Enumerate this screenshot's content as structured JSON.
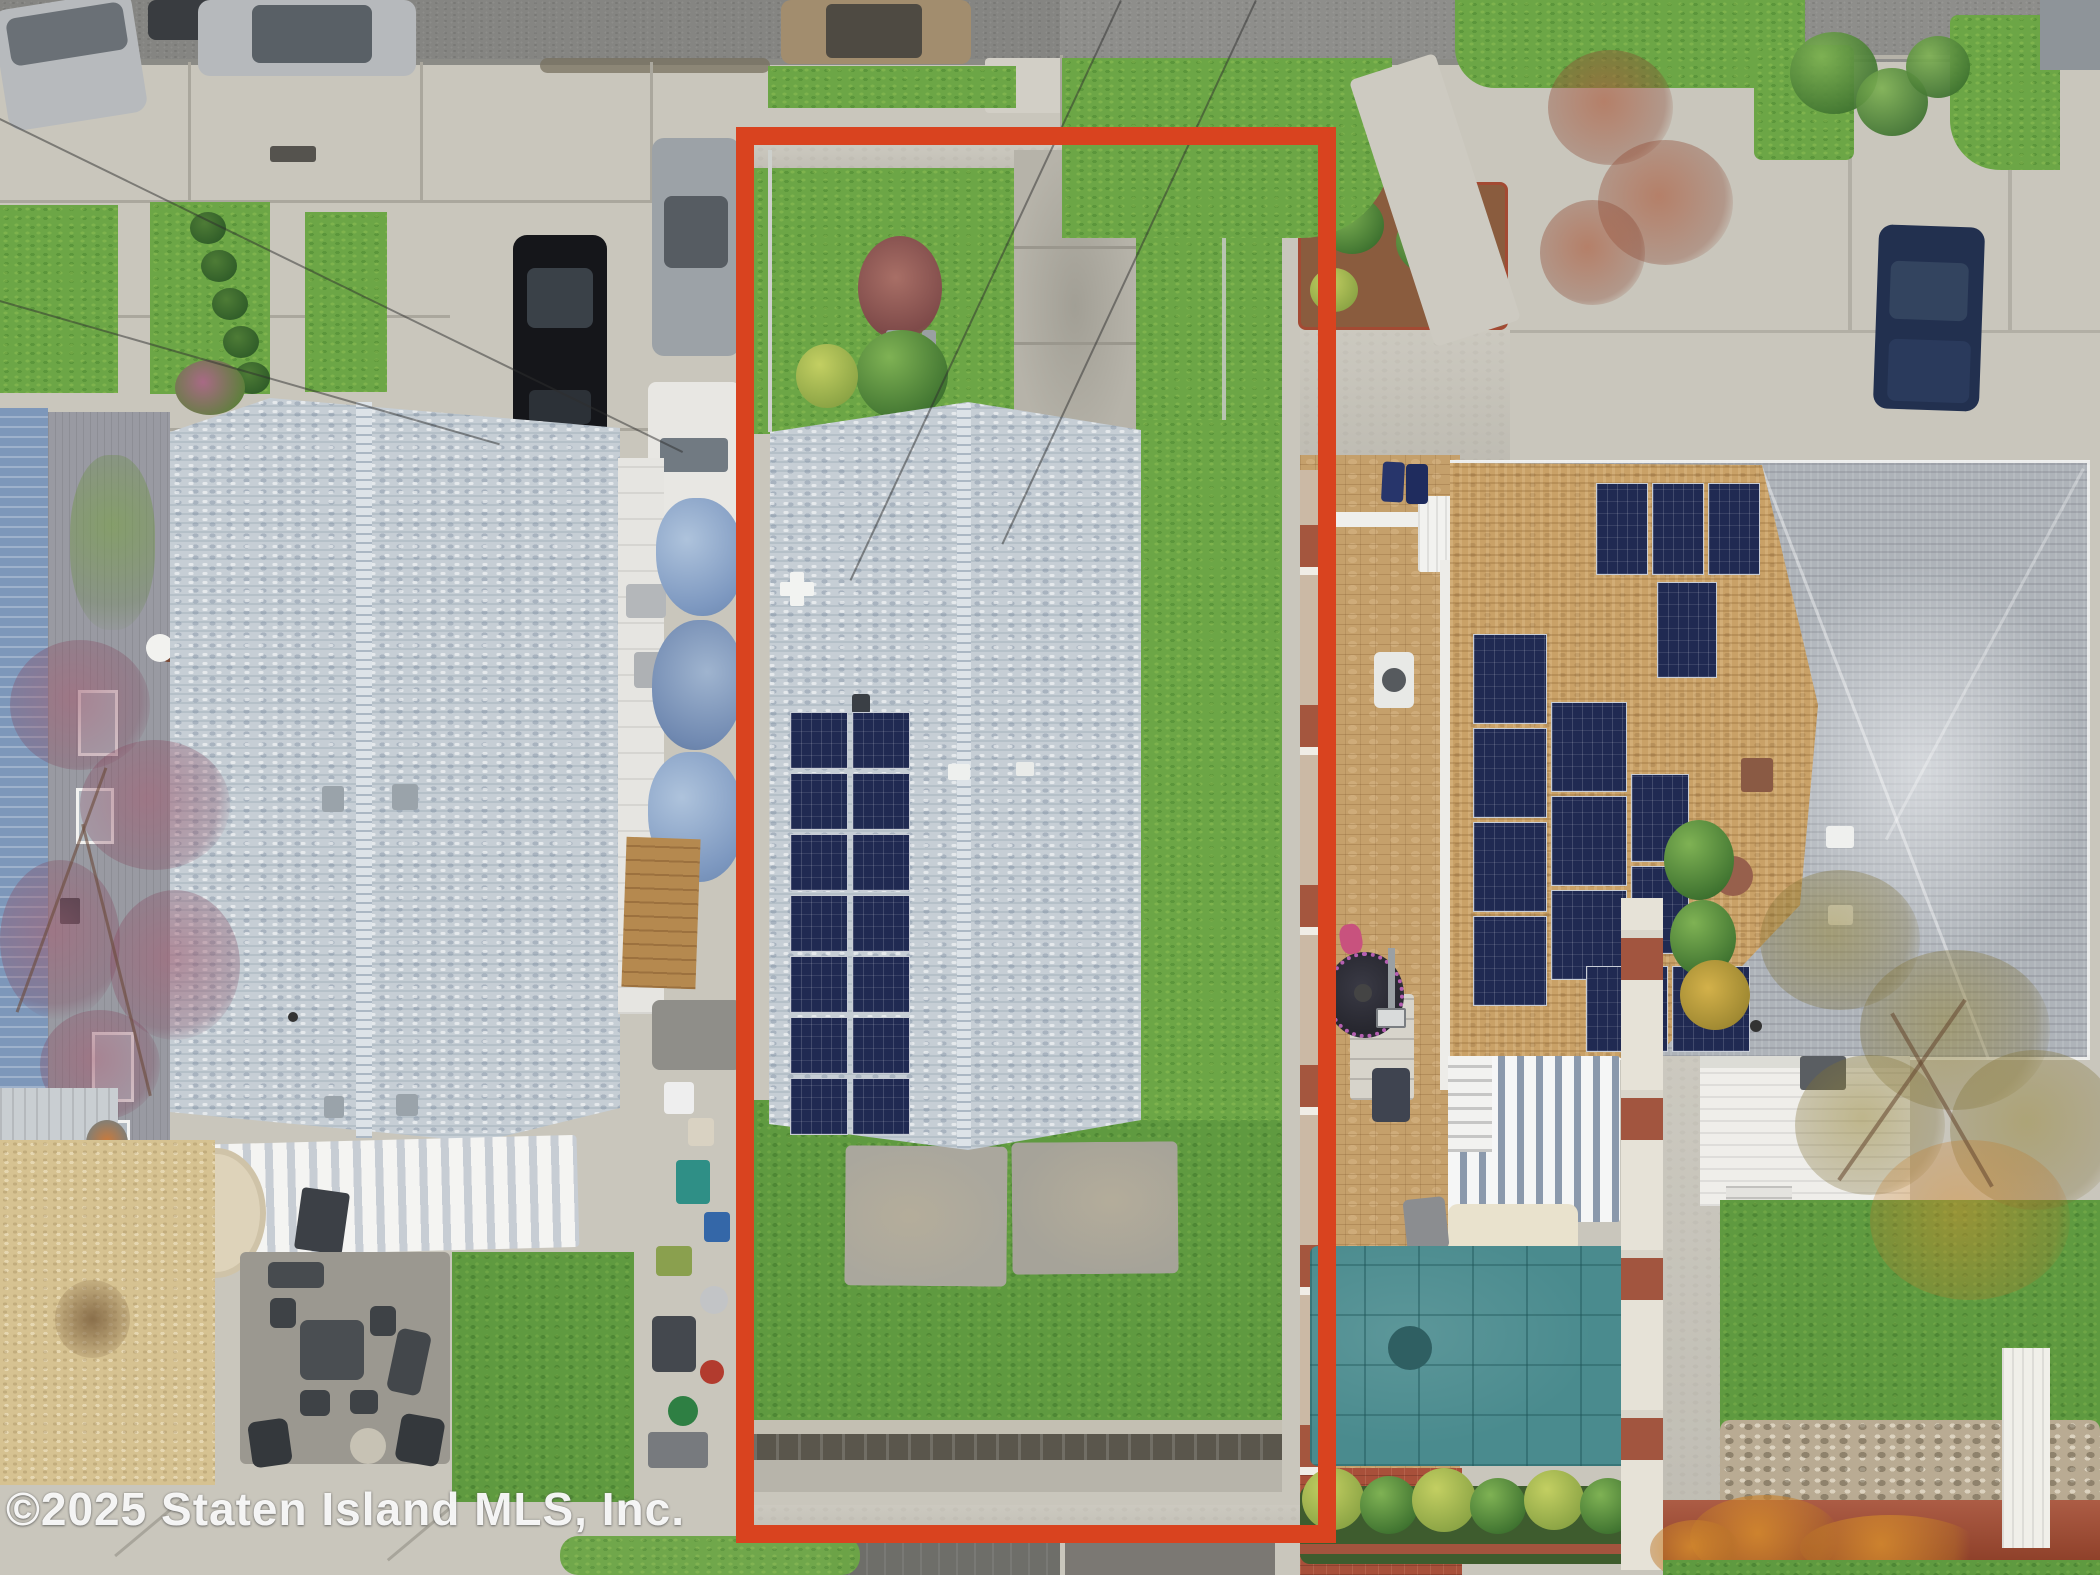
{
  "watermark": {
    "text": "©2025 Staten Island MLS, Inc."
  },
  "scene": {
    "type": "aerial-drone-photo",
    "description": "Top-down aerial view of a residential block; the subject narrow lot is outlined with a thick red rectangle. The subject house has a light gray shingle roof with a 2x7 rooftop solar array, front lawn with shrubs, concrete walkway, rear concrete patio and deep grass backyard. Neighboring houses include a large gray-roof home on the left, and a large home on the right with a tan/gray hip roof covered in solar panels, a covered pool, paver patios, parked cars on the street and driveways.",
    "highlight_color": "#d9431f",
    "palette": {
      "grass": "#6ca646",
      "asphalt_street": "#8e8e8b",
      "concrete": "#c9c6bc",
      "subject_roof": "#c6ced5",
      "solar_panel": "#202a52",
      "right_roof_tan": "#c9a167",
      "right_roof_gray": "#aeb3b9",
      "pool_cover_teal": "#4a8b8e",
      "paver_tan": "#c5a06b",
      "tarp_blue": "#7d98c0"
    },
    "objects": [
      "subject-property-lot",
      "subject-house-roof",
      "subject-solar-array",
      "front-lawn",
      "front-walkway",
      "rear-patio-slabs",
      "backyard-lawn",
      "left-house-roof",
      "left-backyard-patio",
      "driveway-clutter-tarps",
      "right-house-hip-roof",
      "right-house-solar-array",
      "covered-pool",
      "paver-patio",
      "trampoline",
      "street-parked-cars",
      "navy-car-driveway",
      "curb-lawns",
      "boundary-brick-walls",
      "autumn-trees"
    ]
  }
}
